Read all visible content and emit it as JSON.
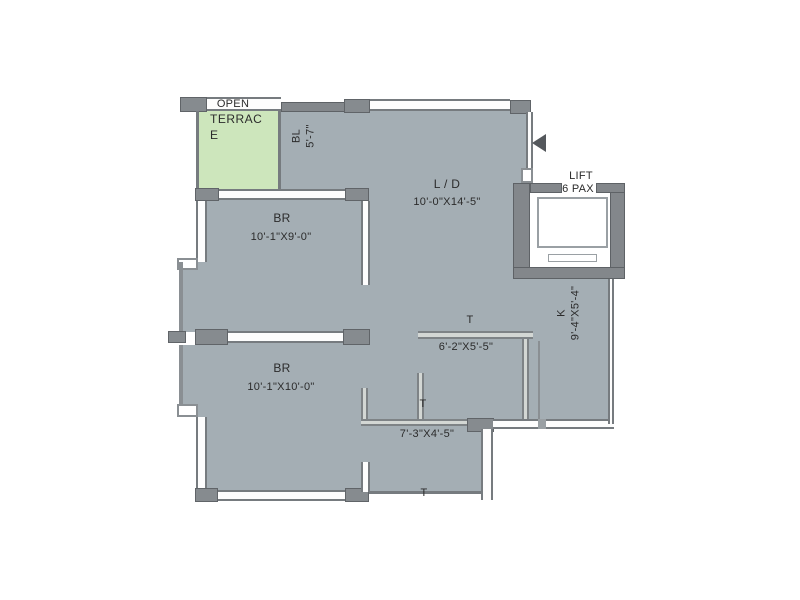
{
  "plan": {
    "type": "apartment floor plan"
  },
  "colors": {
    "room_fill": "#a4aeb4",
    "terrace_fill": "#cde6bc",
    "wall_dark": "#868b8f",
    "wall_line": "#767b7f",
    "text": "#2b2b2b"
  },
  "rooms": {
    "open_terrace": {
      "word1": "OPEN",
      "word2": "TERRACE"
    },
    "balcony": {
      "name": "BL",
      "dims": "5'-7\""
    },
    "living_dining": {
      "name": "L / D",
      "dims": "10'-0\"X14'-5\""
    },
    "bedroom_top": {
      "name": "BR",
      "dims": "10'-1\"X9'-0\""
    },
    "bedroom_bottom": {
      "name": "BR",
      "dims": "10'-1\"X10'-0\""
    },
    "kitchen": {
      "name": "K",
      "dims": "9'-4\"X5'-4\""
    },
    "toilet_top": {
      "name": "T",
      "dims": "6'-2\"X5'-5\""
    },
    "toilet_mid": {
      "name": "T",
      "dims": "7'-3\"X4'-5\""
    },
    "toilet_bottom": {
      "name": "T"
    },
    "lift": {
      "name": "LIFT",
      "capacity": "6 PAX"
    }
  }
}
